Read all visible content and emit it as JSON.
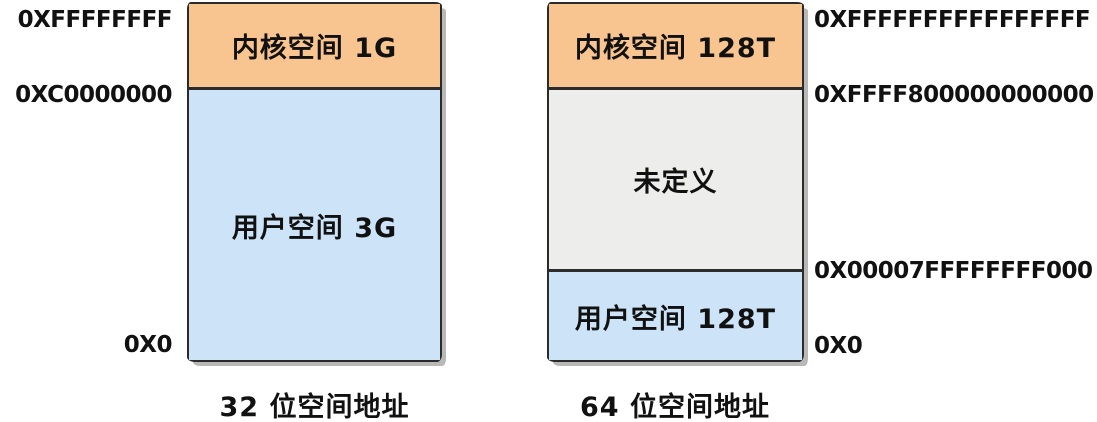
{
  "colors": {
    "kernel_space": "#F8C48F",
    "user_space": "#CCE3F8",
    "undefined_space": "#EDEDEB",
    "border": "#2b2b2b",
    "shadow": "#b8b8b6",
    "text": "#111111",
    "background": "#ffffff"
  },
  "diagram32": {
    "caption": "32 位空间地址",
    "segments": {
      "kernel": {
        "label": "内核空间 1G"
      },
      "user": {
        "label": "用户空间 3G"
      }
    },
    "addresses": {
      "top": "0XFFFFFFFF",
      "kernel_base": "0XC0000000",
      "bottom": "0X0"
    }
  },
  "diagram64": {
    "caption": "64 位空间地址",
    "segments": {
      "kernel": {
        "label": "内核空间 128T"
      },
      "undefined": {
        "label": "未定义"
      },
      "user": {
        "label": "用户空间 128T"
      }
    },
    "addresses": {
      "top": "0XFFFFFFFFFFFFFFFF",
      "kernel_base": "0XFFFF800000000000",
      "user_top": "0X00007FFFFFFFF000",
      "bottom": "0X0"
    }
  }
}
